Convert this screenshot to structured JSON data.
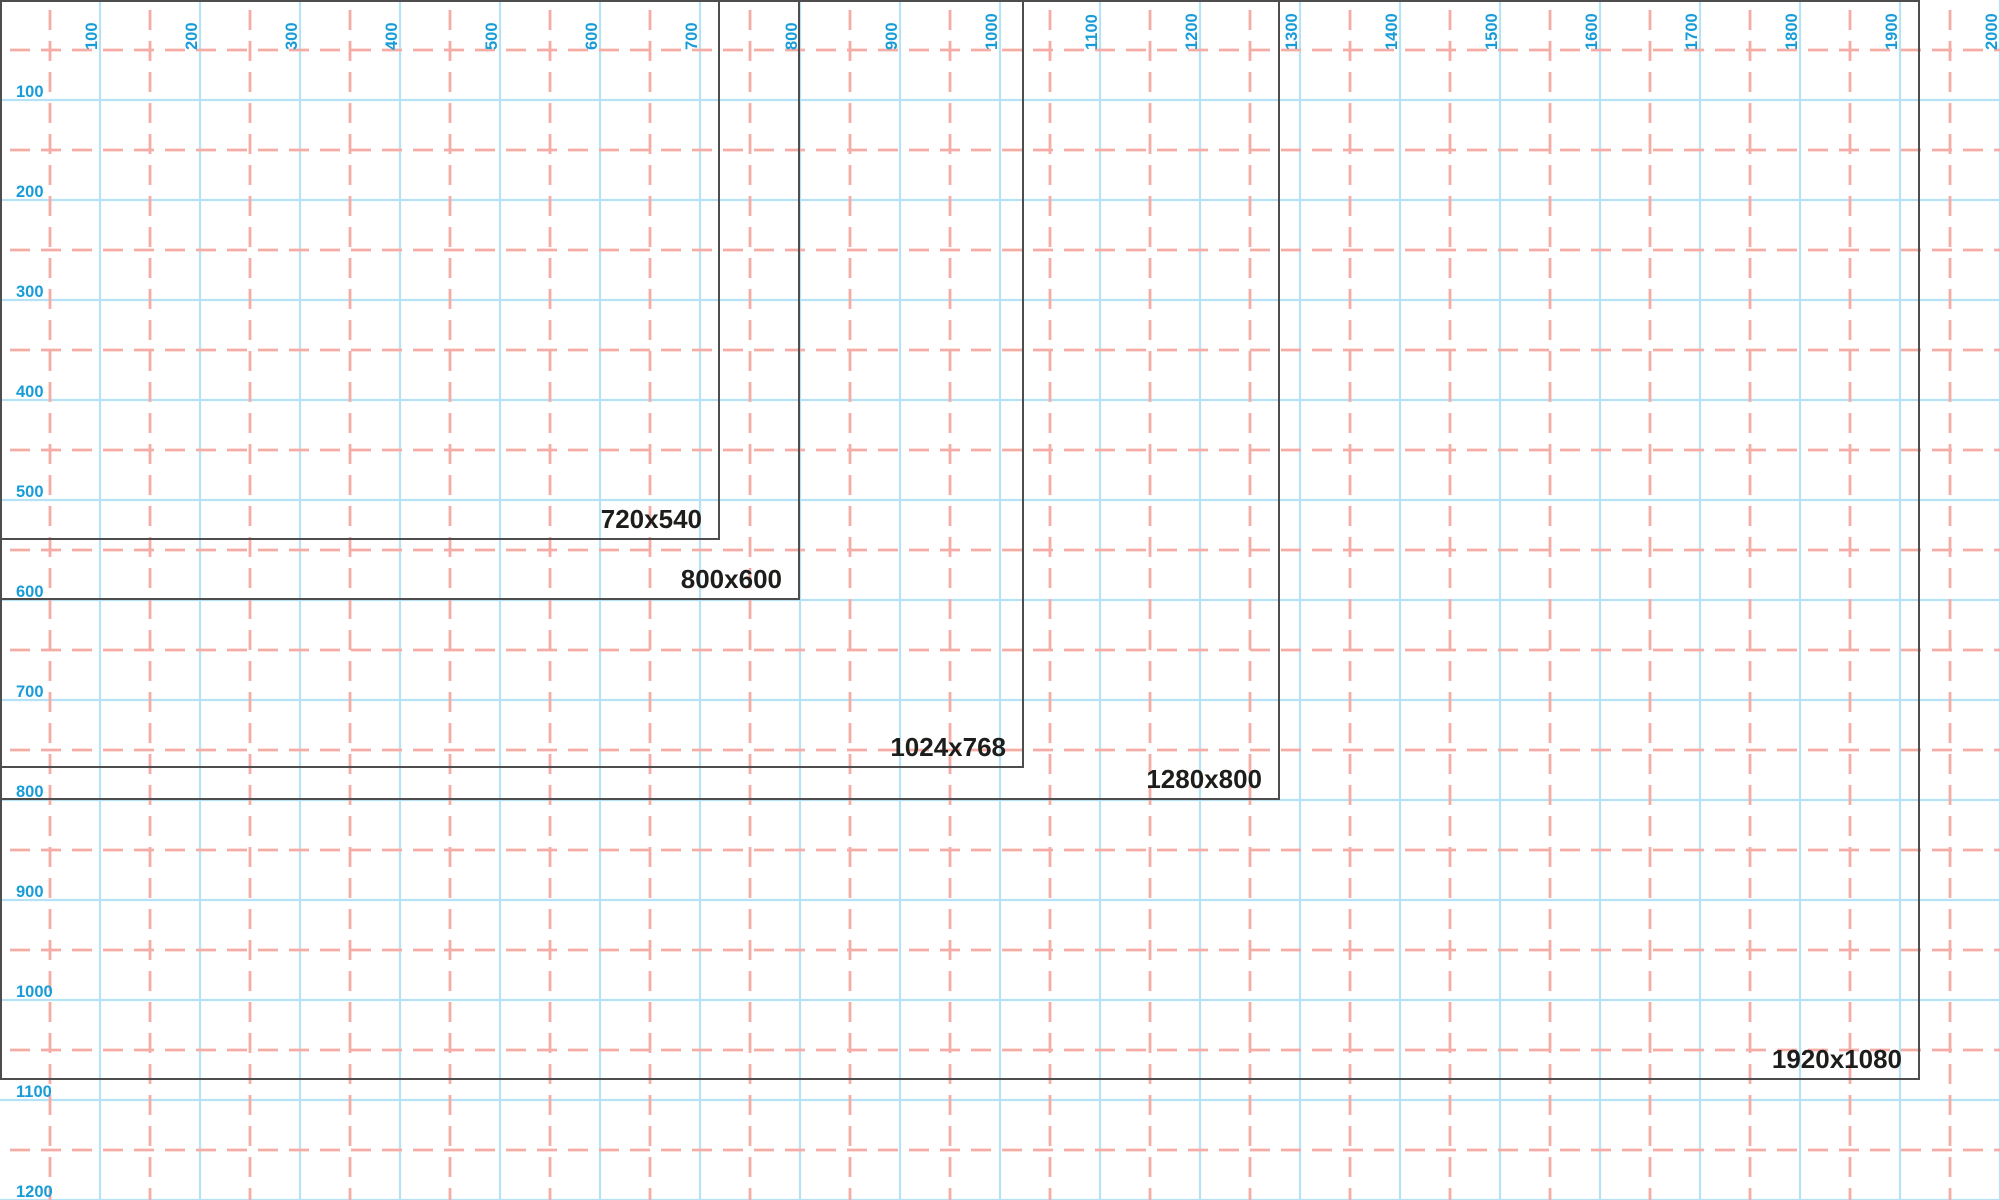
{
  "canvas": {
    "width": 2000,
    "height": 1200,
    "background_color": "#ffffff"
  },
  "grid": {
    "major_line_color": "#b5e2f5",
    "major_line_width": 2.2,
    "major_spacing": 100,
    "minor_dashed_color": "#f5aca5",
    "minor_line_width": 2.8,
    "minor_spacing": 100,
    "minor_offset": 50,
    "minor_dash": "20 11"
  },
  "axes": {
    "tick_label_color": "#189cd8",
    "top_ticks": [
      {
        "label": "100",
        "x": 100
      },
      {
        "label": "200",
        "x": 200
      },
      {
        "label": "300",
        "x": 300
      },
      {
        "label": "400",
        "x": 400
      },
      {
        "label": "500",
        "x": 500
      },
      {
        "label": "600",
        "x": 600
      },
      {
        "label": "700",
        "x": 700
      },
      {
        "label": "800",
        "x": 800
      },
      {
        "label": "900",
        "x": 900
      },
      {
        "label": "1000",
        "x": 1000
      },
      {
        "label": "1100",
        "x": 1100
      },
      {
        "label": "1200",
        "x": 1200
      },
      {
        "label": "1300",
        "x": 1300
      },
      {
        "label": "1400",
        "x": 1400
      },
      {
        "label": "1500",
        "x": 1500
      },
      {
        "label": "1600",
        "x": 1600
      },
      {
        "label": "1700",
        "x": 1700
      },
      {
        "label": "1800",
        "x": 1800
      },
      {
        "label": "1900",
        "x": 1900
      },
      {
        "label": "2000",
        "x": 2000
      }
    ],
    "left_ticks": [
      {
        "label": "100",
        "y": 100
      },
      {
        "label": "200",
        "y": 200
      },
      {
        "label": "300",
        "y": 300
      },
      {
        "label": "400",
        "y": 400
      },
      {
        "label": "500",
        "y": 500
      },
      {
        "label": "600",
        "y": 600
      },
      {
        "label": "700",
        "y": 700
      },
      {
        "label": "800",
        "y": 800
      },
      {
        "label": "900",
        "y": 900
      },
      {
        "label": "1000",
        "y": 1000
      },
      {
        "label": "1100",
        "y": 1100
      },
      {
        "label": "1200",
        "y": 1200
      }
    ]
  },
  "resolutions": {
    "outline_color": "#4d4d4d",
    "outline_width": 2,
    "label_color": "#1d1d1b",
    "items": [
      {
        "label": "720x540",
        "width": 720,
        "height": 540
      },
      {
        "label": "800x600",
        "width": 800,
        "height": 600
      },
      {
        "label": "1024x768",
        "width": 1024,
        "height": 768
      },
      {
        "label": "1280x800",
        "width": 1280,
        "height": 800
      },
      {
        "label": "1920x1080",
        "width": 1920,
        "height": 1080
      }
    ]
  }
}
